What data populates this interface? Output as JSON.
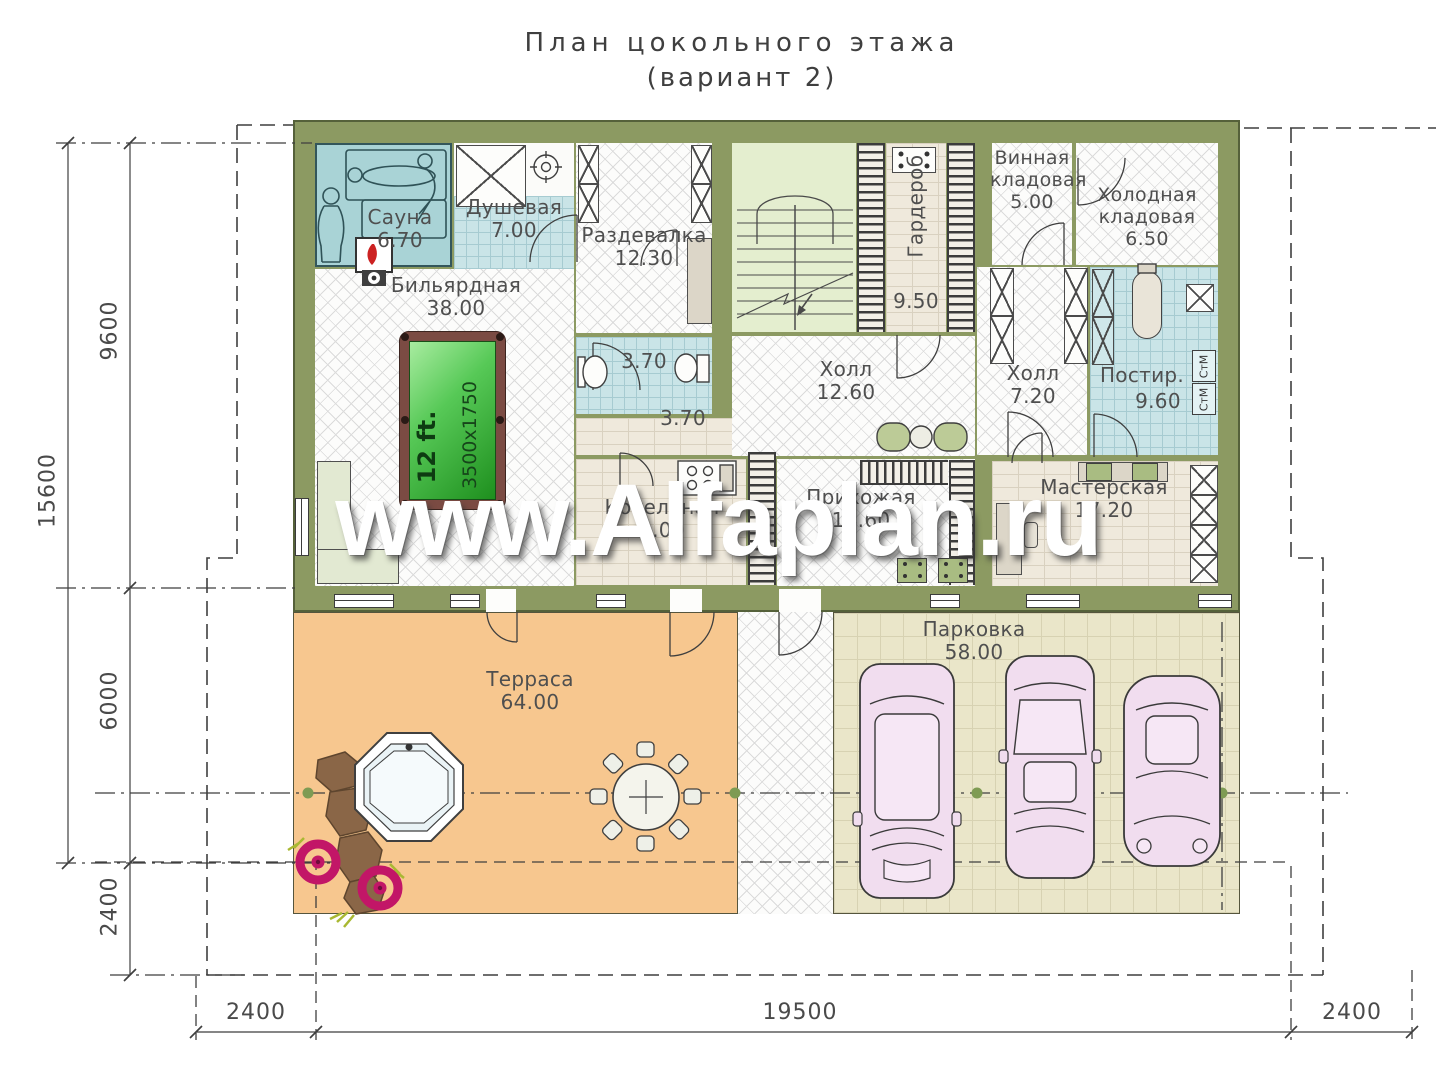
{
  "title": {
    "line1": "План цокольного этажа",
    "line2": "(вариант 2)"
  },
  "watermark": "www.Alfaplan.ru",
  "rooms": {
    "sauna": {
      "name": "Сауна",
      "area": "6.70"
    },
    "shower": {
      "name": "Душевая",
      "area": "7.00"
    },
    "dressing": {
      "name": "Раздевалка",
      "area": "12.30"
    },
    "billiard": {
      "name": "Бильярдная",
      "area": "38.00"
    },
    "bathroom": {
      "area": "3.70"
    },
    "corridor": {
      "area": "3.70"
    },
    "boiler": {
      "name": "Котельная",
      "area": "9.00"
    },
    "wardrobe": {
      "name": "Гардероб",
      "area": "9.50"
    },
    "hall_main": {
      "name": "Холл",
      "area": "12.60"
    },
    "entry_hall": {
      "name": "Прихожая",
      "area": "14.60"
    },
    "wine_pantry": {
      "line1": "Винная",
      "line2": "кладовая",
      "area": "5.00"
    },
    "cold_pantry": {
      "line1": "Холодная",
      "line2": "кладовая",
      "area": "6.50"
    },
    "hall_small": {
      "name": "Холл",
      "area": "7.20"
    },
    "laundry": {
      "name": "Постир.",
      "area": "9.60"
    },
    "workshop": {
      "name": "Мастерская",
      "area": "17.20"
    },
    "terrace": {
      "name": "Терраса",
      "area": "64.00"
    },
    "parking": {
      "name": "Парковка",
      "area": "58.00"
    }
  },
  "billiard_table": {
    "size": "12 ft.",
    "dimensions": "3500x1750"
  },
  "laundry_machines": {
    "washer_top": "СтМ",
    "washer_bottom": "СтМ"
  },
  "dimensions": {
    "left_total": "15600",
    "left_building": "9600",
    "left_terrace": "6000",
    "left_offset": "2400",
    "bottom_left": "2400",
    "bottom_middle": "19500",
    "bottom_right": "2400"
  },
  "colors": {
    "wall": "#8C9A62",
    "terrace": "#F7C78F",
    "parking": "#EAE6C9",
    "wet_room": "#C9E4E7",
    "sauna": "#A9D3D6",
    "stair_room": "#E4EECF",
    "billiard_cloth": "#2FA12F",
    "car": "#F1DDEF",
    "flower": "#C21667"
  }
}
